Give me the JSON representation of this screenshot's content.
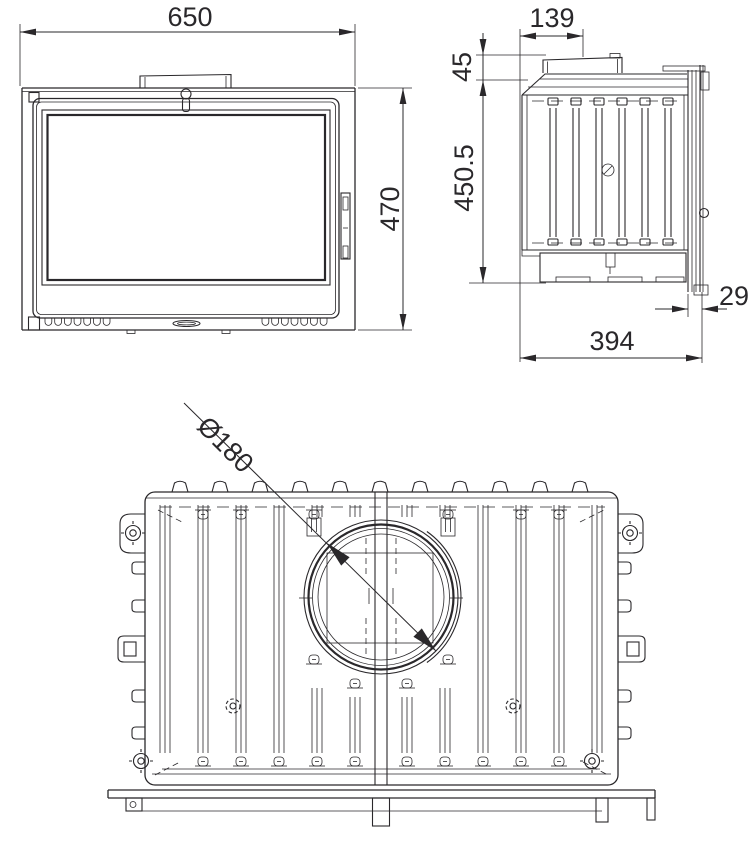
{
  "colors": {
    "line": "#2a282b",
    "background": "#ffffff"
  },
  "views": {
    "front": {
      "width_mm": "650",
      "height_mm": "470"
    },
    "side": {
      "flue_offset_mm": "139",
      "collar_height_mm": "45",
      "body_height_mm": "450.5",
      "door_frame_depth_mm": "29",
      "depth_mm": "394"
    },
    "top": {
      "flue_diameter_mm": "Ø180"
    }
  }
}
